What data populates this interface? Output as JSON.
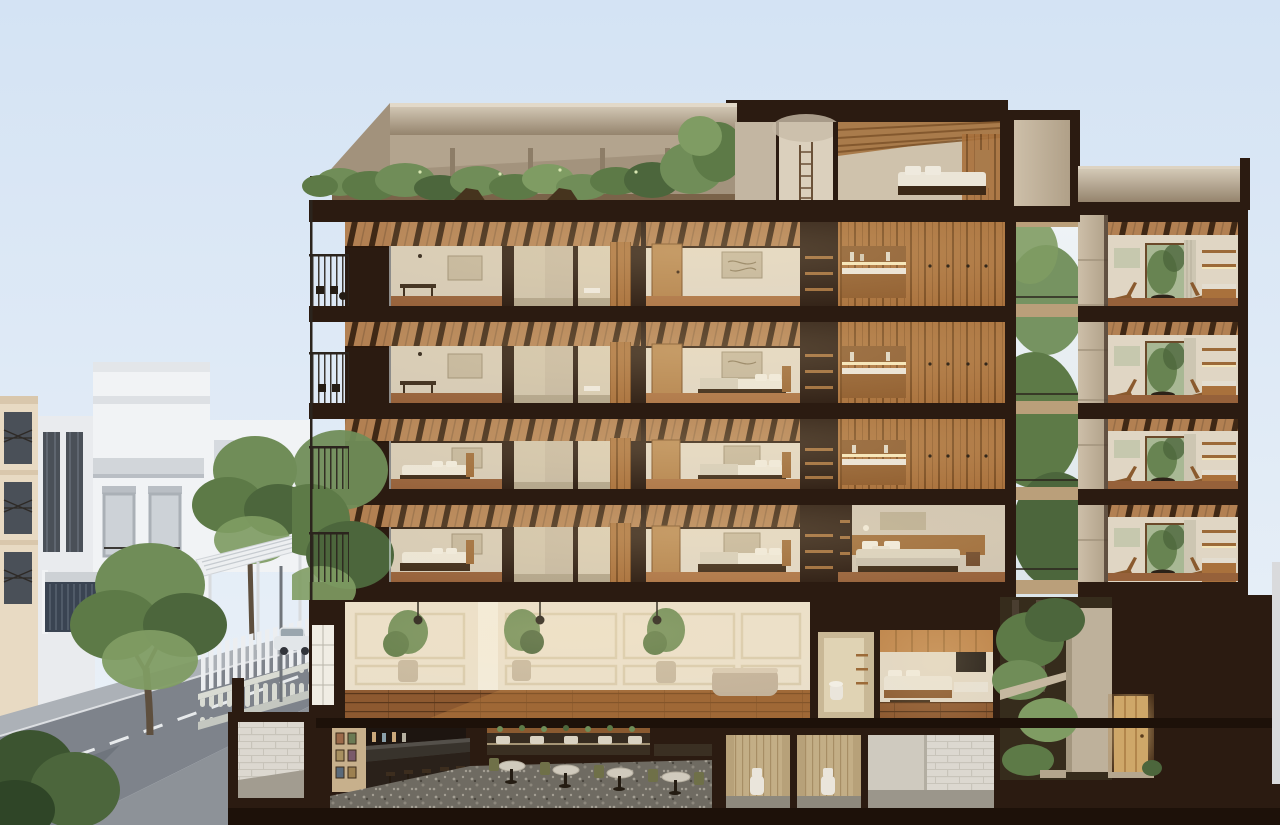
{
  "meta": {
    "label": "Cut-away sectional rendering of a multi-storey building with rooftop terrace, four guest-room floors, ground-floor lobby, garden courtyard and basement bar, beside a city street with white neighbouring buildings and trees"
  },
  "scene": {
    "residential_floors": 4,
    "right_wing_floors": 4,
    "has_rooftop_terrace": true,
    "has_basement_bar": true,
    "street_side": "left",
    "courtyard_trees": true
  },
  "colors": {
    "skyT": "#d4e3f4",
    "skyB": "#ecf2f8",
    "cut": "#2b1b11",
    "cut2": "#1d1109",
    "con": "#c7baa6",
    "conL": "#d9cfbd",
    "conD": "#95846d",
    "beam": "#b28052",
    "beamD": "#352110",
    "wall": "#d5cab6",
    "wallL": "#e0d6c4",
    "wallD": "#c2b59e",
    "flr": "#96613a",
    "flrL": "#ad7546",
    "bath1": "#cfc3ab",
    "bath2": "#d7cbb3",
    "bathF": "#b2a58b",
    "clo": "#a9713c",
    "cloD": "#7b4d22",
    "cloL": "#bd8349",
    "glow": "#f6e7ba",
    "bedW": "#ebe5d7",
    "bedB": "#d5cdba",
    "bedF": "#3c2917",
    "door": "#b5854f",
    "art": "#c2b59c",
    "g1": "#5d7a47",
    "g2": "#708d58",
    "g3": "#4c663c",
    "g4": "#7f9c63",
    "treeD": "#3c5430",
    "trunk": "#5e4f3e",
    "road": "#7e838b",
    "roadD": "#6a6f77",
    "lane": "#e7eaec",
    "walk": "#acb1b7",
    "terr": "#8d9298",
    "white1": "#f1f3f5",
    "white2": "#e9ebee",
    "cream": "#e8dac3",
    "win": "#4a5058",
    "frame": "#aab0b6",
    "store": "#3a4452",
    "balu": "#d9dbd3",
    "fence": "#eceef0",
    "awn": "#edeff1",
    "lobW": "#eadfca",
    "lobP": "#d9cbad",
    "lobF": "#8d5930",
    "pot": "#c7b89f",
    "barF": "#6f6b62",
    "cnt": "#38332c",
    "stool": "#3c2d1e",
    "tbl": "#d0cabd",
    "olive": "#6f7048",
    "bench": "#372c20",
    "stall": "#c3ae86",
    "stallF": "#8e897d",
    "wc": "#eae5db",
    "brick": "#dcd8d0",
    "brickL": "#c8c4ba",
    "brickF": "#9b968b",
    "soil": "#362c1c",
    "gwall": "#beb19b",
    "adoor": "#cea769",
    "strip": "#d9dadc",
    "pent": "#cfc2ac",
    "slat": "#a97b4b",
    "slatD": "#7d5329",
    "csky": "#e9eff3",
    "cbeam": "#ba9f7a",
    "rail": "#2b241d",
    "curt": "#cdc6b2",
    "artG": "#c6c8ae",
    "chair": "#8a5a2e",
    "shelf": "#9c6a38",
    "pil": "#efeade",
    "lampD": "#221c16",
    "car": "#e2e6e9",
    "carG": "#9aa6ae",
    "carD": "#31343a",
    "post": "#70757b",
    "deck": "#7a6349"
  }
}
